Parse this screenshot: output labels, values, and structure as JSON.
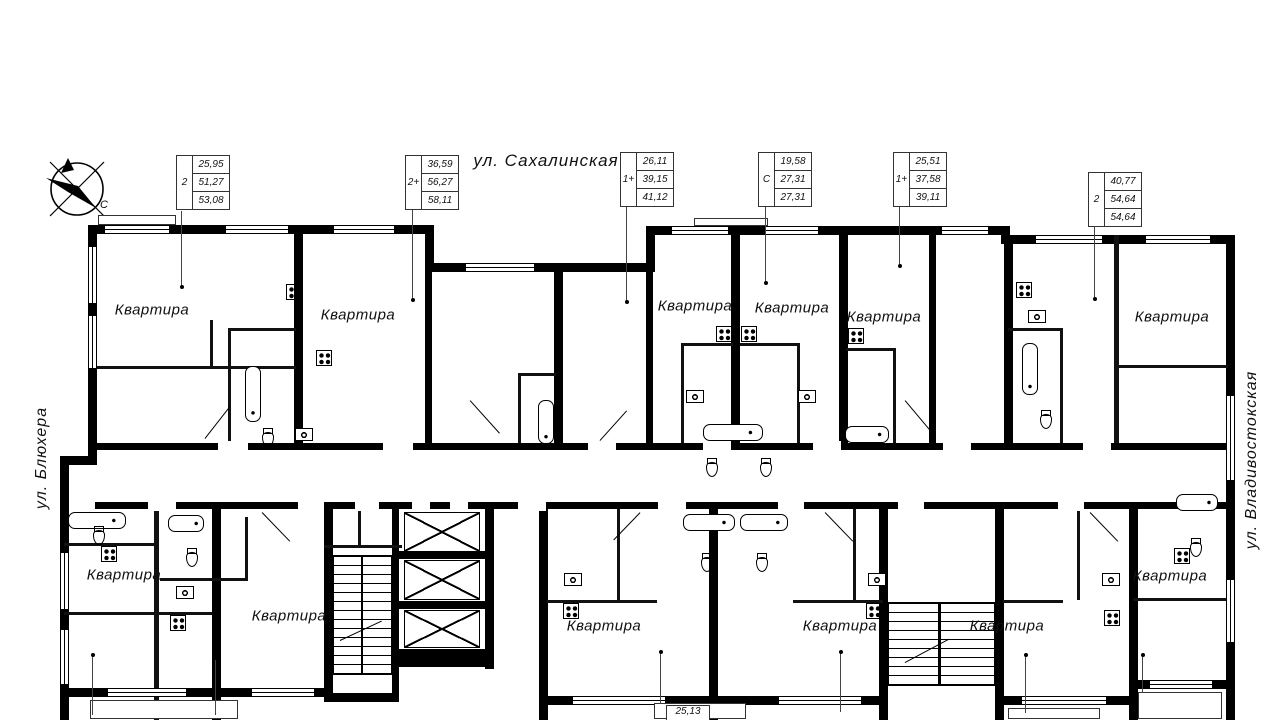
{
  "streets": {
    "top": "ул. Сахалинская",
    "left": "ул. Блюхера",
    "right": "ул. Владивостокская"
  },
  "compass": {
    "north_label": "С"
  },
  "area_tables": [
    {
      "type": "2",
      "values": [
        "25,95",
        "51,27",
        "53,08"
      ]
    },
    {
      "type": "2+",
      "values": [
        "36,59",
        "56,27",
        "58,11"
      ]
    },
    {
      "type": "1+",
      "values": [
        "26,11",
        "39,15",
        "41,12"
      ]
    },
    {
      "type": "С",
      "values": [
        "19,58",
        "27,31",
        "27,31"
      ]
    },
    {
      "type": "1+",
      "values": [
        "25,51",
        "37,58",
        "39,11"
      ]
    },
    {
      "type": "2",
      "values": [
        "40,77",
        "54,64",
        "54,64"
      ]
    }
  ],
  "partial_table": {
    "value": "25,13"
  },
  "apartments": [
    {
      "label": "Квартира"
    },
    {
      "label": "Квартира"
    },
    {
      "label": "Квартира"
    },
    {
      "label": "Квартира"
    },
    {
      "label": "Квартира"
    },
    {
      "label": "Квартира"
    },
    {
      "label": "Квартира"
    },
    {
      "label": "Квартира"
    },
    {
      "label": "Квартира"
    },
    {
      "label": "Квартира"
    },
    {
      "label": "Квартира"
    },
    {
      "label": "Квартира"
    }
  ]
}
